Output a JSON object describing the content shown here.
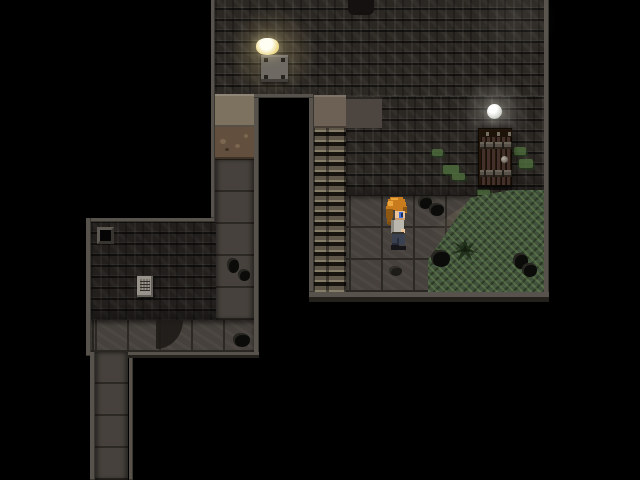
{
  "app": {
    "type": "game-viewport",
    "description": "Top-down pixel-art dungeon scene with stone rooms, corridors, a staircase, a wooden door, lamps, grass and a player character"
  },
  "palette": {
    "bg": "#000000",
    "border": "#57534c",
    "wall_base": "#2b2723",
    "floor_base": "#46413c",
    "floor_line": "#2c2824",
    "dirt_tan": "#7d7160",
    "dirt_brown": "#624f3e",
    "grass_base": "#41503a",
    "stairs_light": "#867d69",
    "stairs_mid": "#5e5749",
    "stairs_dark": "#17130e",
    "landing": "#6d6054",
    "alcove": "#4d4640",
    "door_wood": "#44302a",
    "door_dark": "#241609",
    "door_band": "#6b6559",
    "door_handle": "#6b655c",
    "lamp_plate": "#6e6962",
    "lamp_glow": "#ecd98c",
    "orb": "#d4d6d0",
    "rock": "#0b0b0a",
    "moss": "#4d6b3c",
    "paper": "#99948b",
    "hair": "#c87c1e",
    "skin": "#ecc49c",
    "shirt": "#bab7af",
    "pants": "#3a4150",
    "eye": "#3f6fd8"
  },
  "entities": {
    "player": {
      "label": "Player character",
      "facing": "right"
    },
    "door": {
      "label": "Wooden door"
    },
    "lamp": {
      "label": "Ceiling lamp with glowing bulb"
    },
    "orb": {
      "label": "Glowing orb light"
    },
    "staircase": {
      "label": "Stone staircase"
    },
    "sign": {
      "label": "Paper note on wall"
    },
    "hatch": {
      "label": "Small dark wall hatch"
    },
    "shrub": {
      "label": "Dark shrub in grass"
    },
    "grass": {
      "label": "Grass patch"
    },
    "rock": {
      "label": "Rock debris"
    },
    "upper_room": {
      "label": "Upper stone room"
    },
    "lower_room": {
      "label": "Lower stone room"
    },
    "corridor": {
      "label": "Stone corridor"
    }
  }
}
